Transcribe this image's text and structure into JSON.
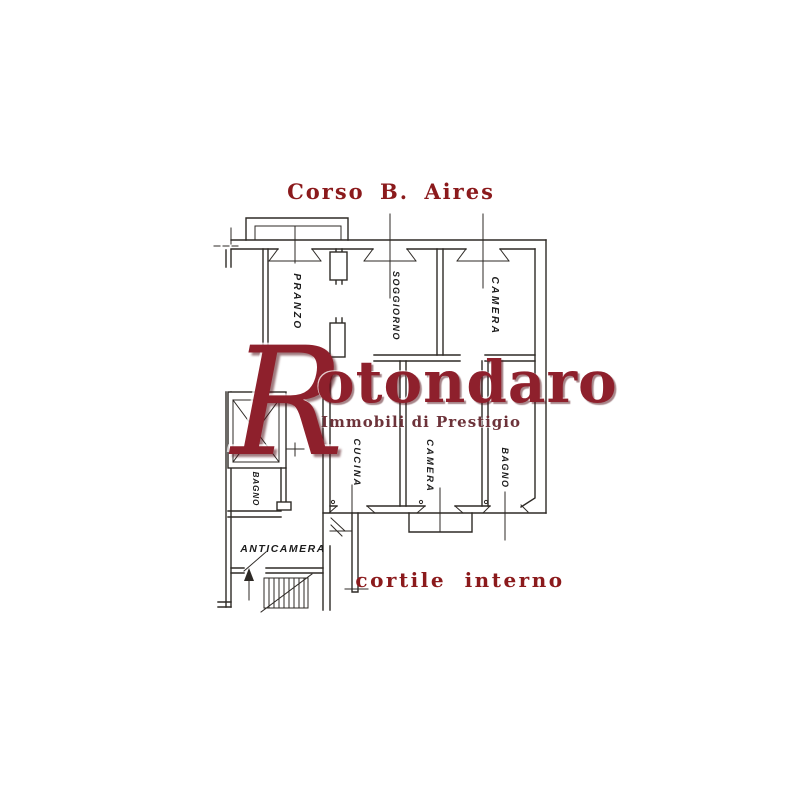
{
  "labels": {
    "street": "Corso B. Aires",
    "courtyard": "cortile interno"
  },
  "watermark": {
    "full": "Rotondaro",
    "initial": "R",
    "rest": "otondaro",
    "tagline": "Immobili di Prestigio"
  },
  "rooms": {
    "pranzo": "PRANZO",
    "soggiorno": "SOGGIORNO",
    "camera_top": "CAMERA",
    "cucina": "CUCINA",
    "camera_bottom": "CAMERA",
    "bagno_main": "BAGNO",
    "cavedio": "CAVEDIO",
    "bagno_small": "BAGNO",
    "anticamera": "ANTICAMERA"
  },
  "colors": {
    "background": "#ffffff",
    "street_label_red": "#8b1a1c",
    "watermark_red": "#8e202c",
    "tagline_red": "#6d333a",
    "plan_line": "#2e2a26"
  }
}
